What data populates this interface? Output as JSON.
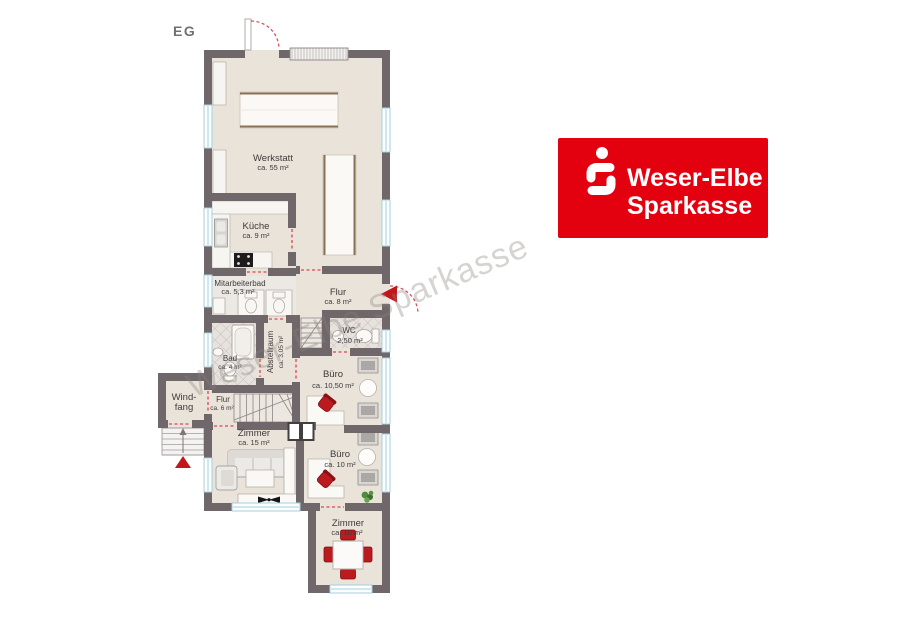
{
  "page": {
    "floor_label": "EG"
  },
  "watermark": {
    "text": "Weser-Elbe Sparkasse"
  },
  "logo": {
    "line1": "Weser-Elbe",
    "line2": "Sparkasse",
    "background_color": "#e3000f",
    "symbol": "sparkasse-s"
  },
  "colors": {
    "wall": "#6f6769",
    "floor": "#e9e3da",
    "bath_floor": "#e7e2dd",
    "window": "#fbfdfe",
    "door_marker": "#d9484f",
    "furniture_red": "#bb1a1f",
    "logo_red": "#e3000f"
  },
  "rooms": [
    {
      "name": "Werkstatt",
      "area": "ca. 55 m²"
    },
    {
      "name": "Küche",
      "area": "ca. 9 m²"
    },
    {
      "name": "Mitarbeiterbad",
      "area": "ca. 5,3 m²"
    },
    {
      "name": "Flur",
      "area": "ca. 8 m²"
    },
    {
      "name": "WC",
      "area": "2,50 m²"
    },
    {
      "name": "Abstellraum",
      "area": "ca. 3,05 m²"
    },
    {
      "name": "Bad",
      "area": "ca. 4 m²"
    },
    {
      "name": "Büro",
      "area": "ca. 10,50 m²"
    },
    {
      "name": "Windfang",
      "line1": "Wind-",
      "line2": "fang"
    },
    {
      "name": "Flur",
      "area": "ca. 6 m²"
    },
    {
      "name": "Zimmer",
      "area": "ca. 15 m²"
    },
    {
      "name": "Büro",
      "area": "ca. 10 m²"
    },
    {
      "name": "Zimmer",
      "area": "ca. 10 m²"
    }
  ]
}
